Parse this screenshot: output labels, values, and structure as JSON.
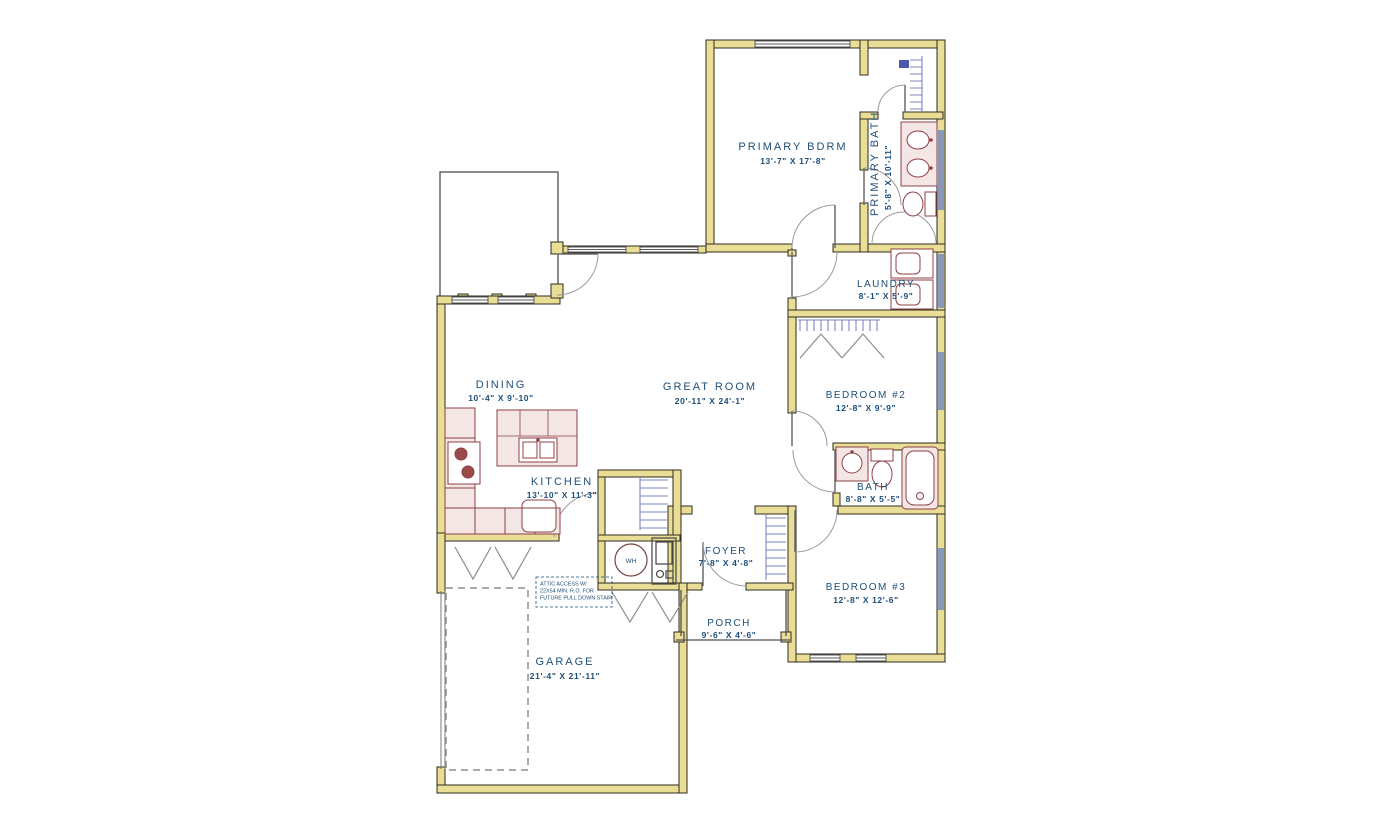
{
  "rooms": {
    "primary_bdrm": {
      "name": "PRIMARY BDRM",
      "dims": "13'-7\" X 17'-8\""
    },
    "primary_bath": {
      "name": "PRIMARY BATH",
      "dims": "5'-8\" X 10'-11\""
    },
    "laundry": {
      "name": "LAUNDRY",
      "dims": "8'-1\" X 5'-9\""
    },
    "great_room": {
      "name": "GREAT ROOM",
      "dims": "20'-11\" X 24'-1\""
    },
    "dining": {
      "name": "DINING",
      "dims": "10'-4\" X 9'-10\""
    },
    "kitchen": {
      "name": "KITCHEN",
      "dims": "13'-10\" X 11'-3\""
    },
    "bedroom2": {
      "name": "BEDROOM #2",
      "dims": "12'-8\" X 9'-9\""
    },
    "bath": {
      "name": "BATH",
      "dims": "8'-8\" X 5'-5\""
    },
    "bedroom3": {
      "name": "BEDROOM #3",
      "dims": "12'-8\" X 12'-6\""
    },
    "foyer": {
      "name": "FOYER",
      "dims": "7'-8\" X 4'-8\""
    },
    "porch": {
      "name": "PORCH",
      "dims": "9'-6\" X 4'-6\""
    },
    "garage": {
      "name": "GARAGE",
      "dims": "21'-4\" X 21'-11\""
    }
  },
  "labels": {
    "water_heater": "WH"
  },
  "note": {
    "line1": "ATTIC ACCESS W/",
    "line2": "22X54 MIN. R.O. FOR",
    "line3": "FUTURE PULL DOWN STAIR"
  },
  "colors": {
    "wall": "#EADE96",
    "label_text": "#1E4E79",
    "fixture_outline": "#8E4046",
    "fixture_fill": "#F3E6E4",
    "shelving": "#7B87BE",
    "window_band": "#8A97B8"
  }
}
